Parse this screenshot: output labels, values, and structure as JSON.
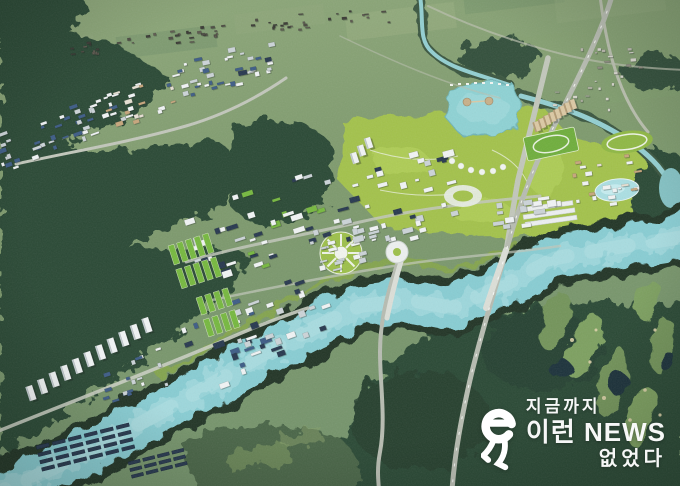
{
  "image": {
    "kind": "aerial-masterplan-render",
    "description": "Bird's-eye 3D rendering of a planned innovation city: white industrial complexes and apartment towers among forested hills, a turquoise river winding to the lower left, a landscaped lake park at upper right and a golf course at lower right.",
    "width": 680,
    "height": 486
  },
  "watermark": {
    "line1": "지금까지",
    "line2": "이런 NEWS",
    "line3": "없었다",
    "logo": "e-runner-logo",
    "color": "#ffffff"
  },
  "palette": {
    "farm": "#7e9a6d",
    "farm_hi": "#90a87d",
    "farm_lo": "#70906a",
    "forest": "#2c4936",
    "forest_dark": "#1f3829",
    "forest_mid": "#3a573f",
    "scrub": "#4a6547",
    "river": "#88cdd3",
    "river_hi": "#b7e4e7",
    "bank": "#203527",
    "levee": "#86a748",
    "park": "#a3c24c",
    "park_hi": "#b8d55c",
    "field_green": "#76b83f",
    "road": "#b7bcb1",
    "road_hi": "#dcdfd8",
    "bld_white": "#f1f4f5",
    "bld_gray": "#ccd4d8",
    "roof_blue": "#3d5c86",
    "roof_navy": "#27384f",
    "tan": "#c7a67c",
    "pond": "#1b333b",
    "fairway": "#73945a",
    "sand": "#ddd2a9",
    "stream": "#93cfd1",
    "pool": "#abdfe3"
  },
  "scene": {
    "clusters": [
      {
        "name": "nw-industrial-a",
        "cx": 36,
        "cy": 139,
        "w": 88,
        "h": 38,
        "rot": -20,
        "n": 24,
        "s": [
          3,
          9
        ],
        "colors": [
          "bld_white",
          "bld_gray",
          "roof_blue"
        ]
      },
      {
        "name": "nw-industrial-b",
        "cx": 95,
        "cy": 115,
        "w": 72,
        "h": 34,
        "rot": -20,
        "n": 20,
        "s": [
          3,
          9
        ],
        "colors": [
          "bld_white",
          "bld_gray",
          "roof_blue"
        ]
      },
      {
        "name": "nw-midrise-tan",
        "cx": 141,
        "cy": 102,
        "w": 78,
        "h": 38,
        "rot": -18,
        "n": 24,
        "s": [
          3,
          8
        ],
        "colors": [
          "tan",
          "#e7e0d3",
          "bld_white"
        ]
      },
      {
        "name": "n-industrial-a",
        "cx": 187,
        "cy": 78,
        "w": 66,
        "h": 32,
        "rot": -15,
        "n": 18,
        "s": [
          3,
          8
        ],
        "colors": [
          "bld_white",
          "bld_gray",
          "roof_blue"
        ]
      },
      {
        "name": "n-industrial-b",
        "cx": 233,
        "cy": 65,
        "w": 78,
        "h": 38,
        "rot": -12,
        "n": 22,
        "s": [
          3,
          9
        ],
        "colors": [
          "bld_white",
          "bld_gray",
          "roof_blue",
          "roof_navy"
        ]
      },
      {
        "name": "central-industrial-west",
        "cx": 250,
        "cy": 226,
        "w": 138,
        "h": 82,
        "rot": -18,
        "n": 44,
        "s": [
          4,
          12
        ],
        "colors": [
          "bld_white",
          "bld_gray",
          "roof_navy",
          "field_green",
          "bld_white"
        ]
      },
      {
        "name": "central-industrial-east",
        "cx": 390,
        "cy": 200,
        "w": 128,
        "h": 88,
        "rot": -15,
        "n": 42,
        "s": [
          4,
          12
        ],
        "colors": [
          "bld_white",
          "bld_gray",
          "roof_navy",
          "bld_white"
        ]
      },
      {
        "name": "east-building-rows",
        "cx": 512,
        "cy": 209,
        "w": 88,
        "h": 38,
        "rot": -8,
        "n": 13,
        "s": [
          5,
          12
        ],
        "colors": [
          "bld_white",
          "bld_gray"
        ]
      },
      {
        "name": "south-industrial",
        "cx": 253,
        "cy": 331,
        "w": 148,
        "h": 78,
        "rot": -20,
        "n": 40,
        "s": [
          4,
          12
        ],
        "colors": [
          "bld_white",
          "bld_gray",
          "roof_navy",
          "roof_blue"
        ]
      },
      {
        "name": "south-industrial-west",
        "cx": 344,
        "cy": 249,
        "w": 66,
        "h": 34,
        "rot": -15,
        "n": 16,
        "s": [
          3,
          9
        ],
        "colors": [
          "bld_white",
          "bld_gray"
        ]
      },
      {
        "name": "ne-village",
        "cx": 610,
        "cy": 57,
        "w": 58,
        "h": 34,
        "rot": -4,
        "n": 15,
        "s": [
          2,
          6
        ],
        "colors": [
          "#d9d8cf",
          "#b9b8ac",
          "#8f8d80"
        ]
      },
      {
        "name": "east-resort",
        "cx": 604,
        "cy": 180,
        "w": 64,
        "h": 48,
        "rot": -8,
        "n": 20,
        "s": [
          3,
          8
        ],
        "colors": [
          "bld_white",
          "#e7e0d3",
          "tan"
        ]
      },
      {
        "name": "nw-oldtown-a",
        "cx": 145,
        "cy": 40,
        "w": 168,
        "h": 14,
        "rot": -7,
        "n": 34,
        "s": [
          2,
          5
        ],
        "colors": [
          "#4c4a42",
          "#5c584e",
          "#3a3934"
        ]
      },
      {
        "name": "nw-oldtown-b",
        "cx": 322,
        "cy": 20,
        "w": 150,
        "h": 16,
        "rot": -4,
        "n": 26,
        "s": [
          2,
          5
        ],
        "colors": [
          "#4c4a42",
          "#5c584e",
          "#3a3934"
        ]
      },
      {
        "name": "ne-farm-houses",
        "cx": 584,
        "cy": 92,
        "w": 76,
        "h": 36,
        "rot": 0,
        "n": 12,
        "s": [
          2,
          5
        ],
        "colors": [
          "#d5d6cb",
          "#a9ac9c"
        ]
      },
      {
        "name": "west-lowrise",
        "cx": 130,
        "cy": 378,
        "w": 70,
        "h": 40,
        "rot": -18,
        "n": 18,
        "s": [
          3,
          8
        ],
        "colors": [
          "bld_white",
          "bld_gray",
          "roof_blue"
        ]
      }
    ],
    "tower_rows": [
      {
        "name": "apartment-towers-west",
        "x0": 34,
        "y0": 400,
        "x1": 150,
        "y1": 332,
        "count": 11,
        "w": 5.5,
        "h": 15,
        "body": "bld_white",
        "side": "#c3ccd1"
      },
      {
        "name": "apartment-towers-east",
        "x0": 539,
        "y0": 131,
        "x1": 575,
        "y1": 109,
        "count": 8,
        "w": 4.5,
        "h": 10,
        "body": "#dcc9a4",
        "side": "#b59c74"
      },
      {
        "name": "center-highrise",
        "x0": 357,
        "y0": 163,
        "x1": 371,
        "y1": 148,
        "count": 3,
        "w": 5,
        "h": 11,
        "body": "bld_white",
        "side": "#c3ccd1"
      }
    ],
    "grids": [
      {
        "name": "solar-farm-a",
        "x": 36,
        "y": 446,
        "rot": -14,
        "rows": 4,
        "cols": 6,
        "cw": 13,
        "ch": 3.5,
        "gx": 3.5,
        "gy": 4,
        "fill": "roof_navy",
        "stroke": "#16243a"
      },
      {
        "name": "solar-farm-b",
        "x": 128,
        "y": 462,
        "rot": -14,
        "rows": 3,
        "cols": 4,
        "cw": 12,
        "ch": 3.2,
        "gx": 3,
        "gy": 3.6,
        "fill": "roof_navy",
        "stroke": "#16243a"
      },
      {
        "name": "greenhouse-strips-a",
        "x": 168,
        "y": 246,
        "rot": -18,
        "rows": 2,
        "cols": 5,
        "cw": 6,
        "ch": 20,
        "gx": 3,
        "gy": 5,
        "fill": "field_green",
        "stroke": "#dfeccd"
      },
      {
        "name": "greenhouse-strips-b",
        "x": 196,
        "y": 298,
        "rot": -18,
        "rows": 2,
        "cols": 4,
        "cw": 6,
        "ch": 18,
        "gx": 3,
        "gy": 5,
        "fill": "field_green",
        "stroke": "#dfeccd"
      }
    ]
  }
}
